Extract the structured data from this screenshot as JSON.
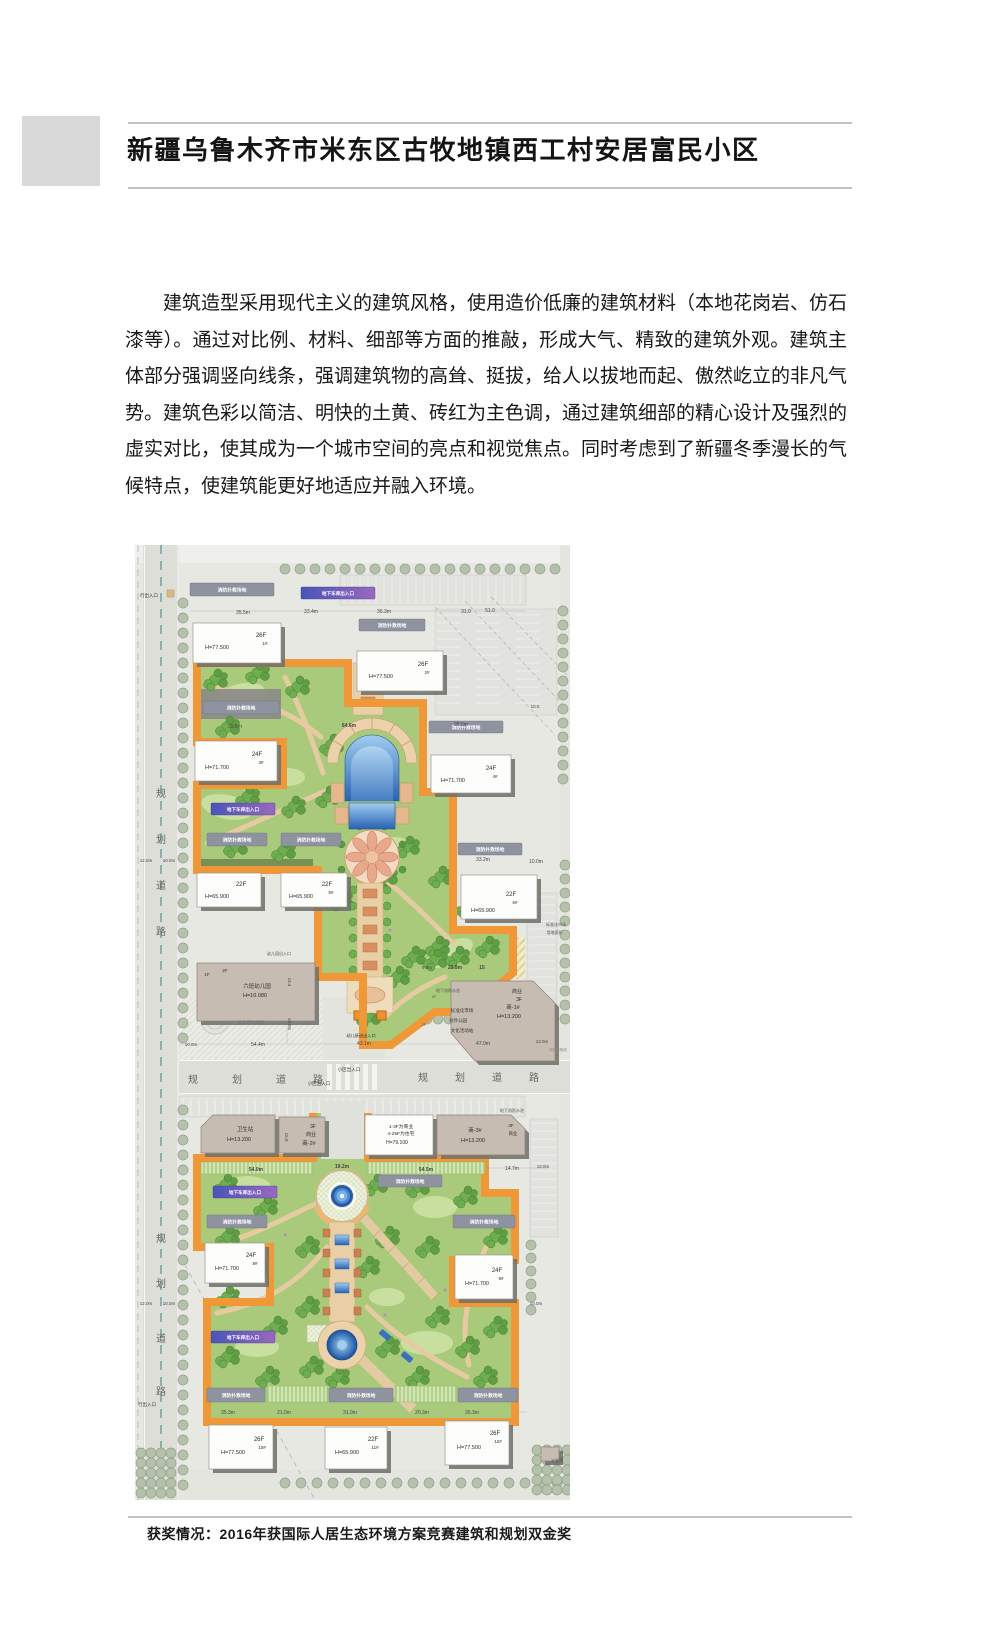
{
  "doc": {
    "title": "新疆乌鲁木齐市米东区古牧地镇西工村安居富民小区",
    "paragraph": "建筑造型采用现代主义的建筑风格，使用造价低廉的建筑材料（本地花岗岩、仿石漆等）。通过对比例、材料、细部等方面的推敲，形成大气、精致的建筑外观。建筑主体部分强调竖向线条，强调建筑物的高耸、挺拔，给人以拔地而起、傲然屹立的非凡气势。建筑色彩以简洁、明快的土黄、砖红为主色调，通过建筑细部的精心设计及强烈的虚实对比，使其成为一个城市空间的亮点和视觉焦点。同时考虑到了新疆冬季漫长的气候特点，使建筑能更好地适应并融入环境。",
    "caption": "获奖情况：2016年获国际人居生态环境方案竞赛建筑和规划双金奖"
  },
  "plan": {
    "colors": {
      "orange_border": "#f09838",
      "courtyard_green": "#a9ca7b",
      "road_gray": "#ddded8",
      "pool_blue": "#2a62b4",
      "building_white": "#fdfdfc",
      "building_tan": "#c6bcb1"
    },
    "fire_pad_label": "消防扑救场地",
    "garage_label": "地下车库出入口",
    "buildings": [
      {
        "type": "w",
        "x": 58,
        "y": 78,
        "w": 88,
        "h": 40,
        "texts": [
          {
            "t": "H=77.500",
            "dx": 24,
            "dy": 26,
            "s": 5.5
          },
          {
            "t": "26F",
            "dx": 68,
            "dy": 14,
            "s": 6
          },
          {
            "t": "1#",
            "dx": 72,
            "dy": 22,
            "s": 4.5
          }
        ]
      },
      {
        "type": "w",
        "x": 222,
        "y": 106,
        "w": 86,
        "h": 40,
        "texts": [
          {
            "t": "H=77.500",
            "dx": 24,
            "dy": 27,
            "s": 5.5
          },
          {
            "t": "26F",
            "dx": 66,
            "dy": 15,
            "s": 6
          },
          {
            "t": "2#",
            "dx": 70,
            "dy": 23,
            "s": 4.5
          }
        ]
      },
      {
        "type": "w",
        "x": 60,
        "y": 196,
        "w": 82,
        "h": 40,
        "texts": [
          {
            "t": "H=71.700",
            "dx": 22,
            "dy": 28,
            "s": 5.5
          },
          {
            "t": "24F",
            "dx": 62,
            "dy": 15,
            "s": 6
          },
          {
            "t": "3#",
            "dx": 66,
            "dy": 23,
            "s": 4.5
          }
        ]
      },
      {
        "type": "w",
        "x": 296,
        "y": 210,
        "w": 80,
        "h": 38,
        "texts": [
          {
            "t": "H=71.700",
            "dx": 22,
            "dy": 27,
            "s": 5.5
          },
          {
            "t": "24F",
            "dx": 60,
            "dy": 15,
            "s": 6
          },
          {
            "t": "4#",
            "dx": 64,
            "dy": 23,
            "s": 4.5
          }
        ]
      },
      {
        "type": "w",
        "x": 62,
        "y": 328,
        "w": 64,
        "h": 34,
        "texts": [
          {
            "t": "H=65.900",
            "dx": 20,
            "dy": 25,
            "s": 5.5
          },
          {
            "t": "22F",
            "dx": 44,
            "dy": 13,
            "s": 6
          }
        ]
      },
      {
        "type": "w",
        "x": 146,
        "y": 328,
        "w": 66,
        "h": 34,
        "texts": [
          {
            "t": "H=65.900",
            "dx": 20,
            "dy": 25,
            "s": 5.5
          },
          {
            "t": "22F",
            "dx": 46,
            "dy": 13,
            "s": 6
          },
          {
            "t": "5#",
            "dx": 50,
            "dy": 21,
            "s": 4.5
          }
        ]
      },
      {
        "type": "w",
        "x": 326,
        "y": 330,
        "w": 76,
        "h": 44,
        "texts": [
          {
            "t": "H=65.900",
            "dx": 22,
            "dy": 37,
            "s": 5.5
          },
          {
            "t": "22F",
            "dx": 50,
            "dy": 21,
            "s": 6
          },
          {
            "t": "6#",
            "dx": 54,
            "dy": 29,
            "s": 4.5
          }
        ]
      },
      {
        "type": "w",
        "x": 230,
        "y": 570,
        "w": 68,
        "h": 40,
        "texts": [
          {
            "t": "1-3F为商业",
            "dx": 36,
            "dy": 13,
            "s": 4.8
          },
          {
            "t": "4-25F为住宅",
            "dx": 36,
            "dy": 20,
            "s": 4.8
          },
          {
            "t": "H=79.100",
            "dx": 32,
            "dy": 29,
            "s": 5
          }
        ]
      },
      {
        "type": "w",
        "x": 70,
        "y": 698,
        "w": 60,
        "h": 40,
        "texts": [
          {
            "t": "H=71.700",
            "dx": 22,
            "dy": 27,
            "s": 5.5
          },
          {
            "t": "24F",
            "dx": 46,
            "dy": 14,
            "s": 6
          },
          {
            "t": "8#",
            "dx": 50,
            "dy": 22,
            "s": 4.5
          }
        ]
      },
      {
        "type": "w",
        "x": 320,
        "y": 710,
        "w": 58,
        "h": 44,
        "texts": [
          {
            "t": "H=71.700",
            "dx": 22,
            "dy": 30,
            "s": 5.5
          },
          {
            "t": "24F",
            "dx": 42,
            "dy": 17,
            "s": 6
          },
          {
            "t": "9#",
            "dx": 46,
            "dy": 25,
            "s": 4.5
          }
        ]
      },
      {
        "type": "w",
        "x": 74,
        "y": 880,
        "w": 64,
        "h": 44,
        "texts": [
          {
            "t": "H=77.500",
            "dx": 24,
            "dy": 29,
            "s": 5.5
          },
          {
            "t": "26F",
            "dx": 50,
            "dy": 16,
            "s": 6
          },
          {
            "t": "10#",
            "dx": 53,
            "dy": 24,
            "s": 4.5
          }
        ]
      },
      {
        "type": "w",
        "x": 190,
        "y": 882,
        "w": 62,
        "h": 42,
        "texts": [
          {
            "t": "H=65.900",
            "dx": 22,
            "dy": 27,
            "s": 5.5
          },
          {
            "t": "22F",
            "dx": 48,
            "dy": 14,
            "s": 6
          },
          {
            "t": "11#",
            "dx": 50,
            "dy": 22,
            "s": 4.5
          }
        ]
      },
      {
        "type": "w",
        "x": 310,
        "y": 876,
        "w": 64,
        "h": 44,
        "texts": [
          {
            "t": "H=77.500",
            "dx": 24,
            "dy": 28,
            "s": 5.5
          },
          {
            "t": "26F",
            "dx": 50,
            "dy": 14,
            "s": 6
          },
          {
            "t": "12#",
            "dx": 53,
            "dy": 22,
            "s": 4.5
          }
        ]
      },
      {
        "type": "t",
        "x": 62,
        "y": 418,
        "w": 118,
        "h": 58,
        "texts": [
          {
            "t": "1F",
            "dx": 10,
            "dy": 13,
            "s": 4.5
          },
          {
            "t": "2F",
            "dx": 28,
            "dy": 9,
            "s": 4.5
          },
          {
            "t": "六班幼儿园",
            "dx": 60,
            "dy": 25,
            "s": 5.5
          },
          {
            "t": "H=10.080",
            "dx": 58,
            "dy": 34,
            "s": 5.5
          }
        ]
      },
      {
        "type": "t",
        "x": 316,
        "y": 436,
        "pts": "316,436 398,436 420,458 420,516 340,516 316,488",
        "texts": [
          {
            "t": "商业",
            "dx": 66,
            "dy": 12,
            "s": 5
          },
          {
            "t": "3F",
            "dx": 68,
            "dy": 20,
            "s": 5
          },
          {
            "t": "商-1#",
            "dx": 62,
            "dy": 28,
            "s": 5.5
          },
          {
            "t": "H=13.200",
            "dx": 58,
            "dy": 37,
            "s": 5.5
          }
        ]
      },
      {
        "type": "t",
        "x": 66,
        "y": 570,
        "pts": "66,582 78,570 140,570 140,608 66,608",
        "texts": [
          {
            "t": "卫生站",
            "dx": 44,
            "dy": 16,
            "s": 5.5
          },
          {
            "t": "H=13.200",
            "dx": 38,
            "dy": 26,
            "s": 5.5
          }
        ]
      },
      {
        "type": "t",
        "x": 144,
        "y": 572,
        "w": 46,
        "h": 36,
        "texts": [
          {
            "t": "3F",
            "dx": 34,
            "dy": 11,
            "s": 5
          },
          {
            "t": "商业",
            "dx": 32,
            "dy": 19,
            "s": 5
          },
          {
            "t": "商-2#",
            "dx": 30,
            "dy": 28,
            "s": 5.5
          }
        ]
      },
      {
        "type": "t",
        "x": 302,
        "y": 570,
        "pts": "302,570 376,570 390,584 390,610 302,610",
        "texts": [
          {
            "t": "商-3#",
            "dx": 38,
            "dy": 17,
            "s": 5.5
          },
          {
            "t": "H=13.200",
            "dx": 36,
            "dy": 27,
            "s": 5.5
          },
          {
            "t": "3F",
            "dx": 74,
            "dy": 12,
            "s": 4.5
          },
          {
            "t": "商业",
            "dx": 76,
            "dy": 20,
            "s": 4.5
          }
        ]
      },
      {
        "type": "t",
        "x": 406,
        "y": 902,
        "w": 18,
        "h": 14,
        "texts": []
      }
    ],
    "fire_pads": [
      [
        55,
        38,
        84,
        13
      ],
      [
        224,
        74,
        66,
        12
      ],
      [
        68,
        156,
        76,
        13
      ],
      [
        294,
        176,
        74,
        12
      ],
      [
        72,
        288,
        60,
        13
      ],
      [
        146,
        288,
        60,
        13
      ],
      [
        323,
        298,
        64,
        12
      ],
      [
        243,
        630,
        64,
        12
      ],
      [
        72,
        670,
        60,
        13
      ],
      [
        318,
        670,
        62,
        13
      ],
      [
        72,
        843,
        58,
        14
      ],
      [
        194,
        843,
        64,
        14
      ],
      [
        323,
        843,
        60,
        14
      ]
    ],
    "garage_bars": [
      [
        166,
        42,
        74,
        12
      ],
      [
        76,
        258,
        64,
        12
      ],
      [
        78,
        641,
        64,
        12
      ],
      [
        76,
        786,
        64,
        12
      ]
    ],
    "green_strips": [
      [
        66,
        617,
        112,
        12
      ],
      [
        232,
        617,
        118,
        12
      ],
      [
        132,
        841,
        60,
        16
      ],
      [
        260,
        841,
        61,
        16
      ]
    ],
    "labels": [
      {
        "t": "规",
        "x": 26,
        "y": 252,
        "s": 10,
        "c": "#666"
      },
      {
        "t": "划",
        "x": 26,
        "y": 298,
        "s": 10,
        "c": "#666"
      },
      {
        "t": "道",
        "x": 26,
        "y": 344,
        "s": 10,
        "c": "#666"
      },
      {
        "t": "路",
        "x": 26,
        "y": 390,
        "s": 10,
        "c": "#666"
      },
      {
        "t": "规",
        "x": 26,
        "y": 697,
        "s": 10,
        "c": "#666"
      },
      {
        "t": "划",
        "x": 26,
        "y": 742,
        "s": 10,
        "c": "#666"
      },
      {
        "t": "道",
        "x": 26,
        "y": 797,
        "s": 10,
        "c": "#666"
      },
      {
        "t": "路",
        "x": 26,
        "y": 850,
        "s": 10,
        "c": "#666"
      },
      {
        "t": "规",
        "x": 58,
        "y": 538,
        "s": 10,
        "c": "#666"
      },
      {
        "t": "划",
        "x": 102,
        "y": 538,
        "s": 10,
        "c": "#666"
      },
      {
        "t": "道",
        "x": 146,
        "y": 538,
        "s": 10,
        "c": "#666"
      },
      {
        "t": "路",
        "x": 183,
        "y": 538,
        "s": 10,
        "c": "#666"
      },
      {
        "t": "规",
        "x": 288,
        "y": 536,
        "s": 10,
        "c": "#666"
      },
      {
        "t": "划",
        "x": 325,
        "y": 536,
        "s": 10,
        "c": "#666"
      },
      {
        "t": "道",
        "x": 362,
        "y": 536,
        "s": 10,
        "c": "#666"
      },
      {
        "t": "路",
        "x": 399,
        "y": 536,
        "s": 10,
        "c": "#666"
      },
      {
        "t": "行出入口",
        "x": 14,
        "y": 52,
        "s": 4.5,
        "c": "#333"
      },
      {
        "t": "行出入口",
        "x": 12,
        "y": 861,
        "s": 4.5,
        "c": "#333"
      },
      {
        "t": "小区出入口",
        "x": 214,
        "y": 526,
        "s": 4.5,
        "c": "#333"
      },
      {
        "t": "小区出入口",
        "x": 184,
        "y": 540,
        "s": 4.5,
        "c": "#333"
      },
      {
        "t": "幼儿园出入口",
        "x": 144,
        "y": 410,
        "s": 4,
        "c": "#555"
      },
      {
        "t": "幼儿活动场地",
        "x": 116,
        "y": 479,
        "s": 4.5,
        "c": "#777"
      },
      {
        "t": "幼儿接送出入口",
        "x": 226,
        "y": 492,
        "s": 4.2,
        "c": "#333"
      },
      {
        "t": "地下消防水池",
        "x": 313,
        "y": 447,
        "s": 4,
        "c": "#555"
      },
      {
        "t": "地下消防水池",
        "x": 377,
        "y": 567,
        "s": 4,
        "c": "#555"
      },
      {
        "t": "标准化市场",
        "x": 327,
        "y": 467,
        "s": 4.5,
        "c": "#333"
      },
      {
        "t": "对外公园",
        "x": 323,
        "y": 477,
        "s": 4.5,
        "c": "#333"
      },
      {
        "t": "文化活动站",
        "x": 327,
        "y": 487,
        "s": 4.5,
        "c": "#333"
      },
      {
        "t": "2F",
        "x": 299,
        "y": 453,
        "s": 4,
        "c": "#555"
      },
      {
        "t": "2F",
        "x": 289,
        "y": 481,
        "s": 4,
        "c": "#555"
      },
      {
        "t": "标准化市场",
        "x": 421,
        "y": 381,
        "s": 4,
        "c": "#555"
      },
      {
        "t": "用地面积:",
        "x": 420,
        "y": 389,
        "s": 4,
        "c": "#555"
      },
      {
        "t": "水箱间",
        "x": 422,
        "y": 917,
        "s": 4,
        "c": "#555"
      },
      {
        "t": "规划建筑线",
        "x": 423,
        "y": 506,
        "s": 3.5,
        "c": "#888"
      },
      {
        "t": "35.5m",
        "x": 108,
        "y": 69
      },
      {
        "t": "33.4m",
        "x": 176,
        "y": 68
      },
      {
        "t": "36.3m",
        "x": 249,
        "y": 68
      },
      {
        "t": "31.0",
        "x": 331,
        "y": 68
      },
      {
        "t": "51.0",
        "x": 355,
        "y": 67
      },
      {
        "t": "35.5m",
        "x": 100,
        "y": 183
      },
      {
        "t": "64.6m",
        "x": 214,
        "y": 182,
        "b": 1
      },
      {
        "t": "35.5m",
        "x": 326,
        "y": 181
      },
      {
        "t": "33.2m",
        "x": 348,
        "y": 316
      },
      {
        "t": "10.0m",
        "x": 401,
        "y": 318
      },
      {
        "t": "12.0m",
        "x": 11,
        "y": 317,
        "s": 4.5
      },
      {
        "t": "10.0m",
        "x": 34,
        "y": 317,
        "s": 4.5
      },
      {
        "t": "10.0",
        "x": 400,
        "y": 163,
        "s": 4.5
      },
      {
        "t": "19.4",
        "x": 153,
        "y": 437,
        "s": 4.5,
        "r": 90
      },
      {
        "t": "19.0m",
        "x": 153,
        "y": 479,
        "s": 4.5,
        "r": 90
      },
      {
        "t": "10.0m",
        "x": 56,
        "y": 501,
        "s": 4.5
      },
      {
        "t": "54.4m",
        "x": 123,
        "y": 501
      },
      {
        "t": "43.1m",
        "x": 229,
        "y": 500
      },
      {
        "t": "47.0m",
        "x": 348,
        "y": 500
      },
      {
        "t": "12.0m",
        "x": 407,
        "y": 498,
        "s": 4.5
      },
      {
        "t": "54.0m",
        "x": 121,
        "y": 626,
        "b": 1
      },
      {
        "t": "19.2m",
        "x": 207,
        "y": 623,
        "b": 1
      },
      {
        "t": "54.5m",
        "x": 291,
        "y": 626,
        "b": 1
      },
      {
        "t": "14.7m",
        "x": 377,
        "y": 625
      },
      {
        "t": "12.0m",
        "x": 408,
        "y": 623,
        "s": 4.5
      },
      {
        "t": "15.0",
        "x": 150,
        "y": 592,
        "s": 4.5,
        "r": 90
      },
      {
        "t": "9.0m",
        "x": 292,
        "y": 424,
        "s": 4.5
      },
      {
        "t": "22.5m",
        "x": 320,
        "y": 424,
        "b": 1
      },
      {
        "t": "15",
        "x": 347,
        "y": 424,
        "b": 1
      },
      {
        "t": "35.3m",
        "x": 93,
        "y": 869
      },
      {
        "t": "21.0m",
        "x": 149,
        "y": 869
      },
      {
        "t": "31.0m",
        "x": 215,
        "y": 869
      },
      {
        "t": "20.3m",
        "x": 287,
        "y": 869
      },
      {
        "t": "35.3m",
        "x": 337,
        "y": 869
      },
      {
        "t": "12.0m",
        "x": 11,
        "y": 760,
        "s": 4.5
      },
      {
        "t": "10.0m",
        "x": 34,
        "y": 760,
        "s": 4.5
      },
      {
        "t": "10.0m",
        "x": 401,
        "y": 760,
        "s": 4.5
      }
    ]
  }
}
